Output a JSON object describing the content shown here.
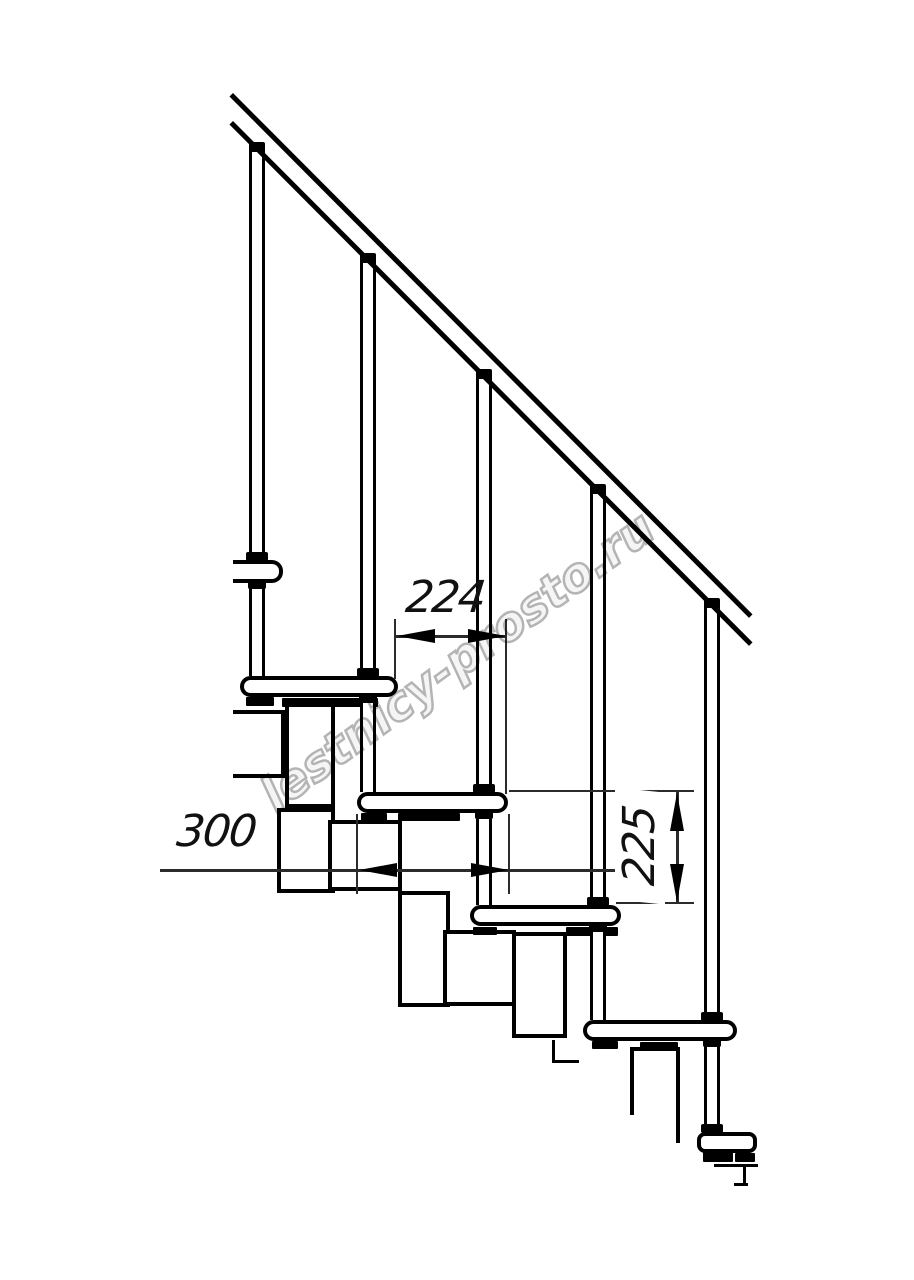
{
  "drawing": {
    "type": "technical-line-drawing",
    "subject": "modular staircase side view fragment with handrail, balusters, treads and support modules",
    "colors": {
      "line": "#000000",
      "background": "#ffffff",
      "dimension_line": "#2b2b2b",
      "watermark": "#b4b4b4"
    },
    "dimensions": [
      {
        "value": "224",
        "orientation": "horizontal",
        "meaning": "step run between tread front edges"
      },
      {
        "value": "300",
        "orientation": "horizontal",
        "meaning": "tread depth"
      },
      {
        "value": "225",
        "orientation": "vertical",
        "meaning": "riser height between treads"
      }
    ],
    "watermark": {
      "text": "lestnicy-prosto.ru",
      "angle_deg": -36
    }
  },
  "geometry": {
    "rail": [
      {
        "x": 233,
        "y": 93,
        "len": 736,
        "a": 45.1,
        "t": 5
      },
      {
        "x": 233,
        "y": 121,
        "len": 736,
        "a": 45.1,
        "t": 5
      }
    ],
    "treads": [
      {
        "x": 233,
        "y": 560,
        "w": 50,
        "h": 23,
        "cut": "left"
      },
      {
        "x": 240,
        "y": 676,
        "w": 158,
        "h": 21
      },
      {
        "x": 357,
        "y": 792,
        "w": 151,
        "h": 21
      },
      {
        "x": 470,
        "y": 905,
        "w": 151,
        "h": 21
      },
      {
        "x": 583,
        "y": 1020,
        "w": 154,
        "h": 21
      },
      {
        "x": 697,
        "y": 1132,
        "w": 60,
        "h": 21,
        "variant": "bracket"
      }
    ],
    "rods": [
      {
        "x": 257,
        "y0": 151,
        "y1": 560
      },
      {
        "x": 257,
        "y0": 583,
        "y1": 676
      },
      {
        "x": 368,
        "y0": 262,
        "y1": 676
      },
      {
        "x": 368,
        "y0": 697,
        "y1": 792
      },
      {
        "x": 484,
        "y0": 377,
        "y1": 792
      },
      {
        "x": 484,
        "y0": 813,
        "y1": 905
      },
      {
        "x": 598,
        "y0": 492,
        "y1": 905
      },
      {
        "x": 598,
        "y0": 926,
        "y1": 1020
      },
      {
        "x": 712,
        "y0": 607,
        "y1": 1020
      },
      {
        "x": 712,
        "y0": 1041,
        "y1": 1132
      }
    ],
    "caps": [
      {
        "x": 257,
        "y": 142
      },
      {
        "x": 368,
        "y": 253
      },
      {
        "x": 484,
        "y": 369
      },
      {
        "x": 598,
        "y": 484
      },
      {
        "x": 712,
        "y": 598
      }
    ],
    "collars_top": [
      {
        "x": 257,
        "y": 552
      },
      {
        "x": 368,
        "y": 668
      },
      {
        "x": 484,
        "y": 784
      },
      {
        "x": 598,
        "y": 897
      },
      {
        "x": 712,
        "y": 1012
      },
      {
        "x": 712,
        "y": 1124
      }
    ],
    "collars_bottom": [
      {
        "x": 257,
        "y": 582
      },
      {
        "x": 368,
        "y": 696
      },
      {
        "x": 484,
        "y": 812
      },
      {
        "x": 598,
        "y": 925
      },
      {
        "x": 712,
        "y": 1040
      }
    ],
    "feet": [
      {
        "x": 246,
        "y": 697,
        "w": 28,
        "h": 9
      },
      {
        "x": 282,
        "y": 698,
        "w": 96,
        "h": 9
      },
      {
        "x": 361,
        "y": 813,
        "w": 26,
        "h": 8
      },
      {
        "x": 398,
        "y": 813,
        "w": 62,
        "h": 8
      },
      {
        "x": 473,
        "y": 927,
        "w": 24,
        "h": 8
      },
      {
        "x": 566,
        "y": 927,
        "w": 52,
        "h": 9
      },
      {
        "x": 592,
        "y": 1041,
        "w": 26,
        "h": 8
      },
      {
        "x": 640,
        "y": 1042,
        "w": 38,
        "h": 8
      },
      {
        "x": 703,
        "y": 1152,
        "w": 30,
        "h": 10
      },
      {
        "x": 735,
        "y": 1153,
        "w": 20,
        "h": 9
      }
    ],
    "modules": [
      {
        "x": 233,
        "y": 710,
        "w": 52,
        "h": 68,
        "open": "left"
      },
      {
        "x": 285,
        "y": 700,
        "w": 50,
        "h": 108
      },
      {
        "x": 277,
        "y": 808,
        "w": 58,
        "h": 85
      },
      {
        "x": 328,
        "y": 820,
        "w": 74,
        "h": 71
      },
      {
        "x": 398,
        "y": 891,
        "w": 52,
        "h": 116
      },
      {
        "x": 443,
        "y": 930,
        "w": 73,
        "h": 76
      },
      {
        "x": 512,
        "y": 932,
        "w": 55,
        "h": 106
      },
      {
        "x": 630,
        "y": 1047,
        "w": 50,
        "h": 68,
        "open": "bottom"
      }
    ],
    "struct_lines": [
      {
        "x": 676,
        "y": 1049,
        "w": 4,
        "h": 94
      },
      {
        "x": 552,
        "y": 1040,
        "w": 3,
        "h": 23
      },
      {
        "x": 552,
        "y": 1060,
        "w": 27,
        "h": 3
      },
      {
        "x": 714,
        "y": 1164,
        "w": 44,
        "h": 3
      },
      {
        "x": 743,
        "y": 1164,
        "w": 3,
        "h": 22
      },
      {
        "x": 734,
        "y": 1183,
        "w": 14,
        "h": 3
      }
    ],
    "thin_lines": [
      {
        "x": 395,
        "y": 635,
        "w": 112,
        "h": 3
      },
      {
        "x": 394,
        "y": 619,
        "w": 2,
        "h": 60
      },
      {
        "x": 505,
        "y": 619,
        "w": 2,
        "h": 175
      },
      {
        "x": 160,
        "y": 869,
        "w": 457,
        "h": 3
      },
      {
        "x": 356,
        "y": 814,
        "w": 2,
        "h": 80
      },
      {
        "x": 508,
        "y": 814,
        "w": 2,
        "h": 80
      },
      {
        "x": 676,
        "y": 792,
        "w": 3,
        "h": 112
      },
      {
        "x": 509,
        "y": 790,
        "w": 185,
        "h": 2
      },
      {
        "x": 616,
        "y": 902,
        "w": 78,
        "h": 2
      }
    ],
    "arrows": [
      {
        "x": 397,
        "y": 636,
        "dir": "left"
      },
      {
        "x": 506,
        "y": 636,
        "dir": "right"
      },
      {
        "x": 359,
        "y": 870,
        "dir": "left"
      },
      {
        "x": 509,
        "y": 870,
        "dir": "right"
      },
      {
        "x": 677,
        "y": 793,
        "dir": "up"
      },
      {
        "x": 677,
        "y": 902,
        "dir": "down"
      }
    ]
  }
}
